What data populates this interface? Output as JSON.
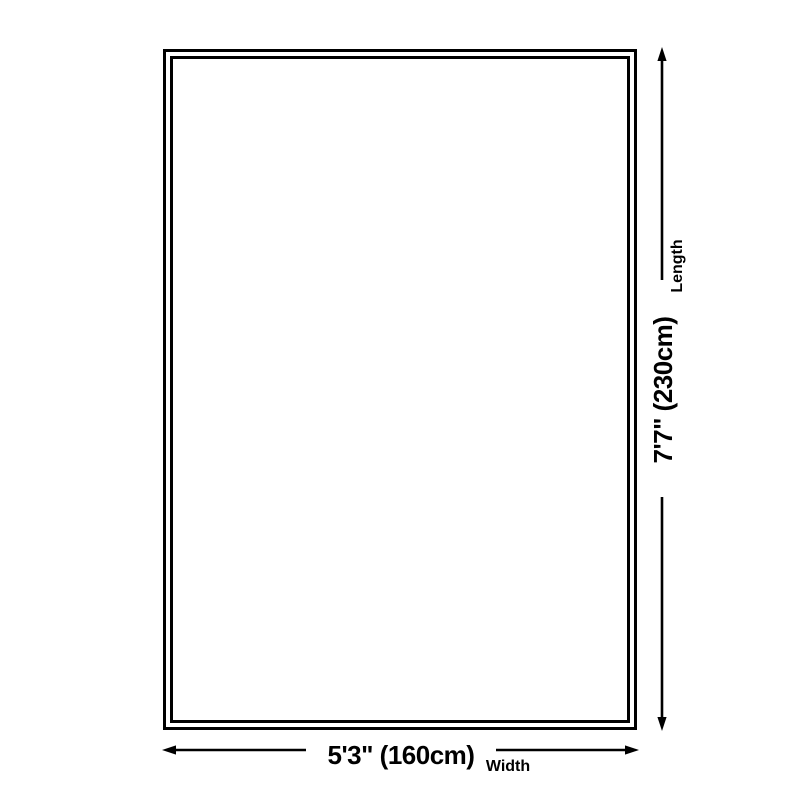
{
  "diagram": {
    "background_color": "#ffffff",
    "line_color": "#000000",
    "length": {
      "value": "7'7\" (230cm)",
      "axis_label": "Length"
    },
    "width": {
      "value": "5'3\" (160cm)",
      "axis_label": "Width"
    }
  }
}
